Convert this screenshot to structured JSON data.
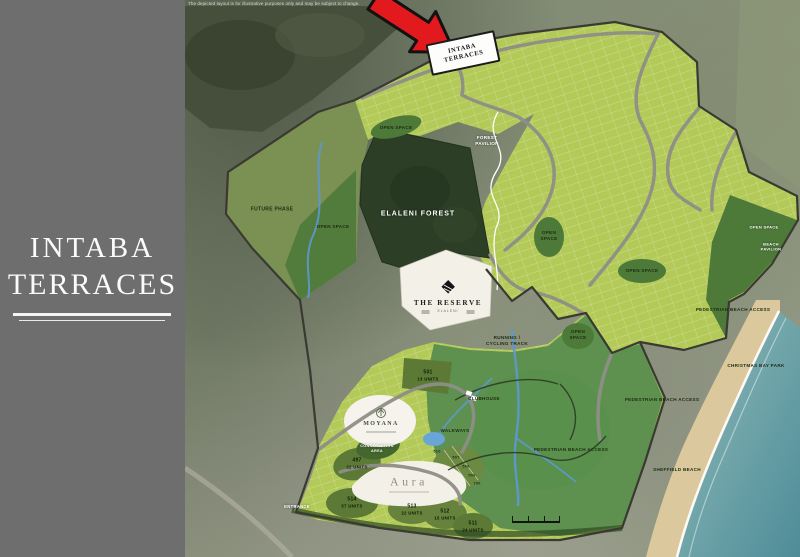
{
  "brand": {
    "line1": "INTABA",
    "line2": "TERRACES"
  },
  "map": {
    "disclaimer": "The depicted layout is for illustrative purposes only and may be subject to change.",
    "sign": {
      "line1": "INTABA",
      "line2": "TERRACES"
    },
    "areas": {
      "open_space": "OPEN SPACE",
      "future_phase": "FUTURE PHASE",
      "elaleni_forest": "ELALENI FOREST",
      "forest_pavilion_l1": "FOREST",
      "forest_pavilion_l2": "PAVILION",
      "beach_pavilion_l1": "BEACH",
      "beach_pavilion_l2": "PAVILION",
      "running_track_l1": "RUNNING /",
      "running_track_l2": "CYCLING TRACK",
      "clubhouse": "CLUBHOUSE",
      "walkways": "WALKWAYS",
      "conservation_l1": "CONSERVATION",
      "conservation_l2": "AREA",
      "entrance": "ENTRANCE"
    },
    "places": {
      "pedestrian_beach_access": "PEDESTRIAN BEACH ACCESS",
      "christmas_bay_park": "CHRISTMAS BAY PARK",
      "sheffield_beach": "SHEFFIELD BEACH"
    },
    "estates": {
      "reserve_name": "THE RESERVE",
      "reserve_sub": "ELALENI",
      "moyana": "MOYANA",
      "aura": "Aura"
    },
    "plots": [
      {
        "no": "501",
        "units": "13 UNITS"
      },
      {
        "no": "497",
        "units": "22 UNITS"
      },
      {
        "no": "514",
        "units": "57 UNITS"
      },
      {
        "no": "513",
        "units": "22 UNITS"
      },
      {
        "no": "512",
        "units": "15 UNITS"
      },
      {
        "no": "511",
        "units": "24 UNITS"
      }
    ],
    "small_plots": [
      "510",
      "507",
      "508",
      "509",
      "700"
    ]
  },
  "colors": {
    "accent_red": "#e2191d",
    "site_green": "#b3ca58",
    "open_space_green": "#4d7a39",
    "forest_green": "#2c3e26",
    "park_green": "#5e9150",
    "white_plot": "#f3f0e8",
    "road_gray": "#8f8f87",
    "sand": "#dcc89d",
    "ocean": "#6aa2a6",
    "sidebar_gray": "#6e6e6e"
  }
}
